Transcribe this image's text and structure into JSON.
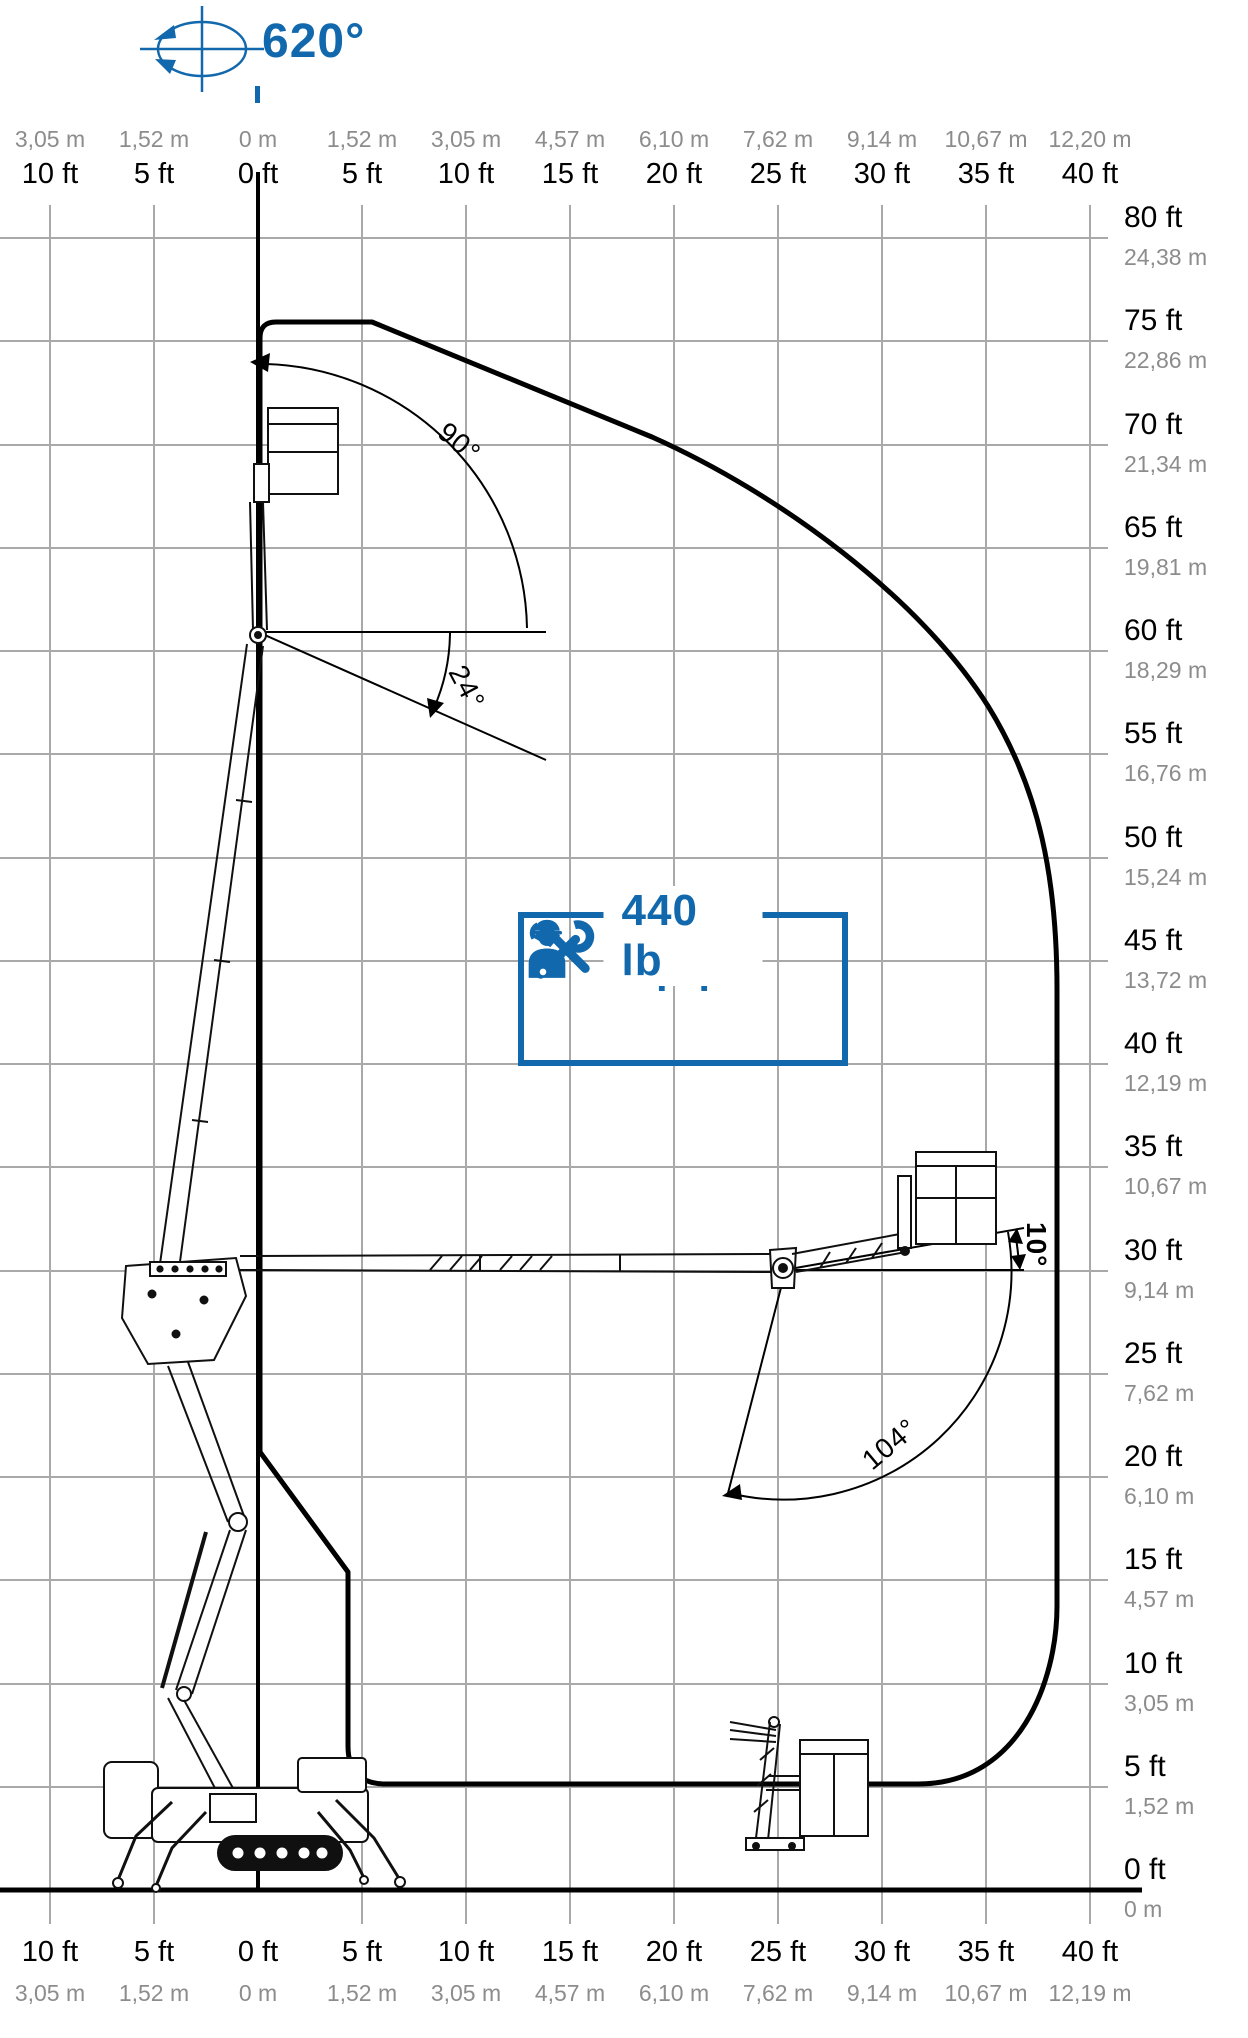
{
  "rotation": {
    "label": "620°"
  },
  "capacity": {
    "label": "440 lb",
    "plus": "+",
    "icons": [
      "worker-icon",
      "worker-icon",
      "tools-icon"
    ]
  },
  "angles": {
    "platform_up": "90°",
    "platform_down": "24°",
    "jib_above_horizontal": "10°",
    "jib_sweep": "104°"
  },
  "top_axis": {
    "meters": [
      "3,05 m",
      "1,52 m",
      "0 m",
      "1,52 m",
      "3,05 m",
      "4,57 m",
      "6,10 m",
      "7,62 m",
      "9,14 m",
      "10,67 m",
      "12,20 m"
    ],
    "feet": [
      "10 ft",
      "5 ft",
      "0 ft",
      "5 ft",
      "10 ft",
      "15 ft",
      "20 ft",
      "25 ft",
      "30 ft",
      "35 ft",
      "40 ft"
    ]
  },
  "bottom_axis": {
    "feet": [
      "10 ft",
      "5 ft",
      "0 ft",
      "5 ft",
      "10 ft",
      "15 ft",
      "20 ft",
      "25 ft",
      "30 ft",
      "35 ft",
      "40 ft"
    ],
    "meters": [
      "3,05 m",
      "1,52 m",
      "0 m",
      "1,52 m",
      "3,05 m",
      "4,57 m",
      "6,10 m",
      "7,62 m",
      "9,14 m",
      "10,67 m",
      "12,19 m"
    ]
  },
  "right_axis": [
    {
      "ft": "80 ft",
      "m": "24,38 m"
    },
    {
      "ft": "75 ft",
      "m": "22,86 m"
    },
    {
      "ft": "70 ft",
      "m": "21,34 m"
    },
    {
      "ft": "65 ft",
      "m": "19,81 m"
    },
    {
      "ft": "60 ft",
      "m": "18,29 m"
    },
    {
      "ft": "55 ft",
      "m": "16,76 m"
    },
    {
      "ft": "50 ft",
      "m": "15,24 m"
    },
    {
      "ft": "45 ft",
      "m": "13,72 m"
    },
    {
      "ft": "40 ft",
      "m": "12,19 m"
    },
    {
      "ft": "35 ft",
      "m": "10,67 m"
    },
    {
      "ft": "30 ft",
      "m": "9,14 m"
    },
    {
      "ft": "25 ft",
      "m": "7,62 m"
    },
    {
      "ft": "20 ft",
      "m": "6,10 m"
    },
    {
      "ft": "15 ft",
      "m": "4,57 m"
    },
    {
      "ft": "10 ft",
      "m": "3,05 m"
    },
    {
      "ft": "5 ft",
      "m": "1,52 m"
    },
    {
      "ft": "0 ft",
      "m": "0 m"
    }
  ],
  "colors": {
    "accent": "#1268ac",
    "grid": "#a9a9a9",
    "meters_text": "#8c8c8c",
    "ink": "#000000"
  }
}
